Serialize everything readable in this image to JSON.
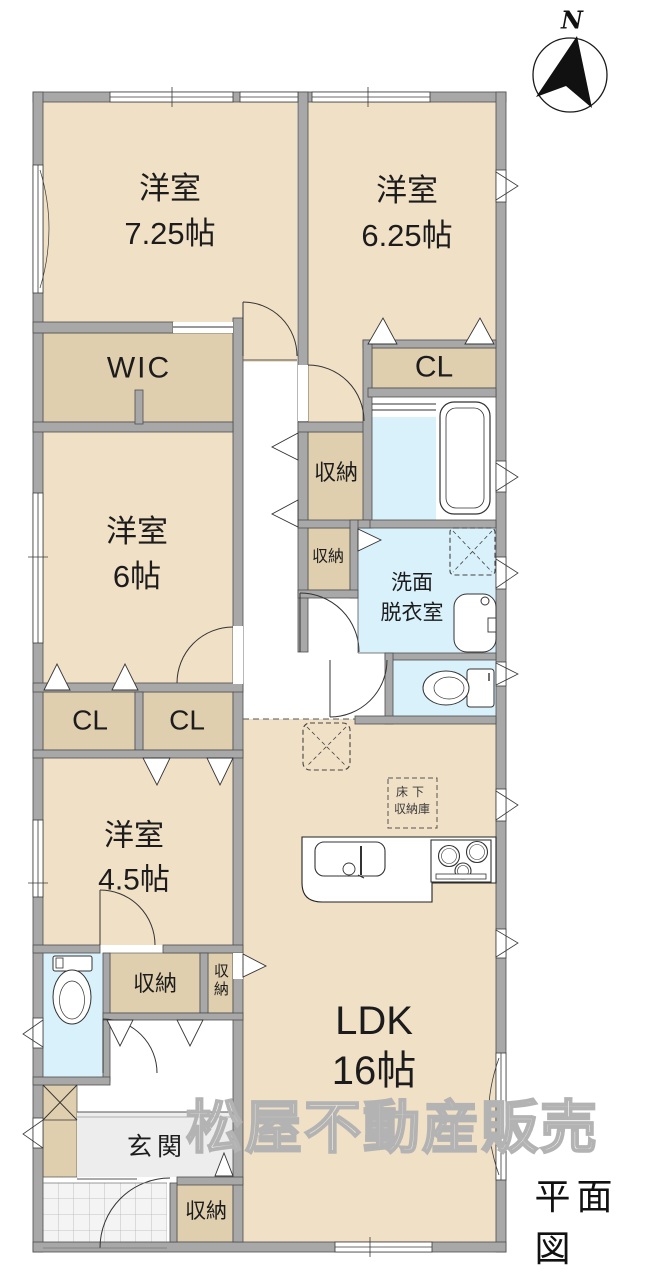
{
  "document": {
    "title": "平面図",
    "watermark": "松屋不動産販売"
  },
  "compass": {
    "north_label": "N"
  },
  "rooms": {
    "bedroom_725": {
      "name": "洋室",
      "size": "7.25帖"
    },
    "bedroom_625": {
      "name": "洋室",
      "size": "6.25帖"
    },
    "bedroom_6": {
      "name": "洋室",
      "size": "6帖"
    },
    "bedroom_45": {
      "name": "洋室",
      "size": "4.5帖"
    },
    "ldk": {
      "name": "LDK",
      "size": "16帖"
    },
    "wic": {
      "label": "WIC"
    },
    "closet_upper": {
      "label": "CL"
    },
    "closet_left": {
      "label": "CL"
    },
    "closet_right": {
      "label": "CL"
    },
    "washroom": {
      "line1": "洗面",
      "line2": "脱衣室"
    },
    "hall_storage_large": {
      "label": "収納"
    },
    "hall_storage_small": {
      "label": "収納"
    },
    "storage_by_toilet": {
      "label": "収納"
    },
    "storage_vertical": {
      "label": "収納"
    },
    "entry": {
      "label": "玄関"
    },
    "entry_storage": {
      "label": "収納"
    },
    "underfloor_storage": {
      "line1": "床下",
      "line2": "収納庫"
    }
  },
  "palette": {
    "floor": "#F0E0C6",
    "closet": "#E0CFAE",
    "wet_area": "#D9F1FB",
    "wall": "#A8A8A8",
    "entry_floor": "#EDEDED"
  }
}
